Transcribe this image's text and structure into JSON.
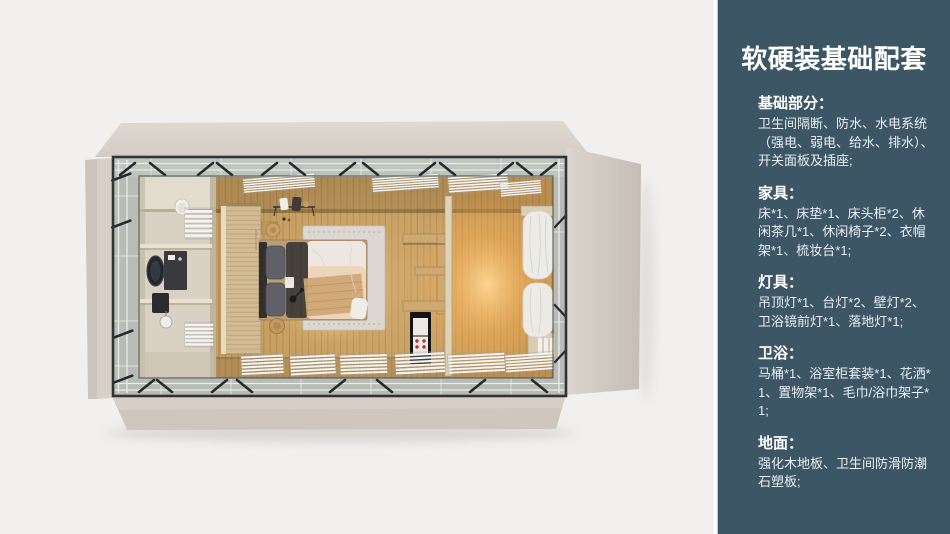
{
  "slide": {
    "width": 950,
    "height": 534
  },
  "colors": {
    "canvas_bg": "#f1f0ee",
    "sidebar_bg": "#3c5666",
    "sidebar_text": "#e9eff2",
    "heading_text": "#ffffff",
    "shell_beige": "#d8d0c8",
    "frame_dark": "#2f343a",
    "glass_band": "#b7bcb6",
    "wood_floor": "#c59e62",
    "warm_glow": "#ffd289",
    "rug_gray": "#dcd7d0",
    "curtain_white": "#edebe7"
  },
  "sidebar": {
    "title": "软硬装基础配套",
    "sections": [
      {
        "id": "basics",
        "heading": "基础部分：",
        "body": "卫生间隔断、防水、水电系统（强电、弱电、给水、排水）、开关面板及插座;"
      },
      {
        "id": "furniture",
        "heading": "家具：",
        "body": "床*1、床垫*1、床头柜*2、休闲茶几*1、休闲椅子*2、衣帽架*1、梳妆台*1;"
      },
      {
        "id": "lighting",
        "heading": "灯具：",
        "body": "吊顶灯*1、台灯*2、壁灯*2、卫浴镜前灯*1、落地灯*1;"
      },
      {
        "id": "bath",
        "heading": "卫浴：",
        "body": "马桶*1、浴室柜套装*1、花洒*1、置物架*1、毛巾/浴巾架子*1;"
      },
      {
        "id": "floor",
        "heading": "地面：",
        "body": "强化木地板、卫生间防滑防潮石塑板;"
      }
    ]
  }
}
